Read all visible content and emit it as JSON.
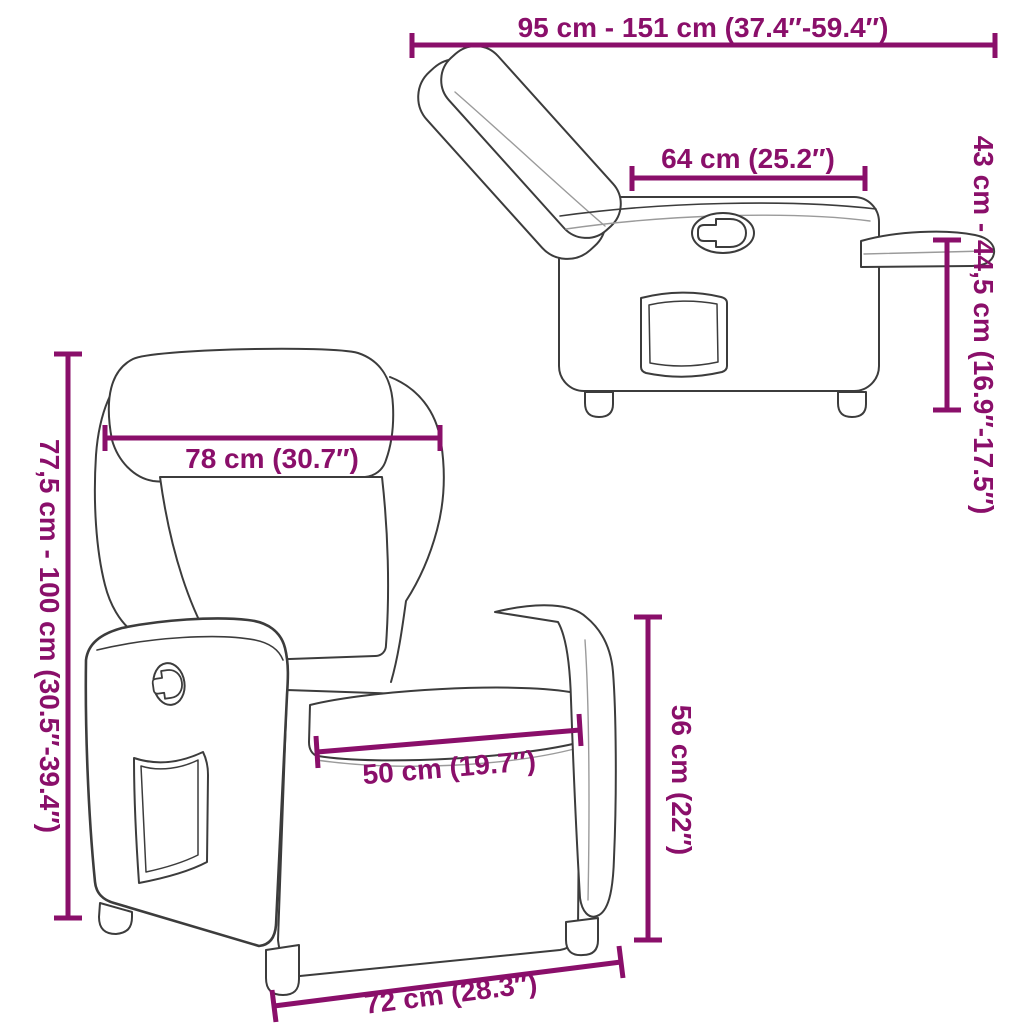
{
  "diagram_type": "furniture-dimension-diagram",
  "colors": {
    "dimension": "#8A0F6A",
    "outline": "#3C3C3C",
    "seam": "#9B9B9B",
    "background": "#FFFFFF"
  },
  "side_view": {
    "dims": {
      "total_length": "95 cm - 151 cm (37.4″-59.4″)",
      "top_depth": "64 cm (25.2″)",
      "footrest_height": "43 cm - 44,5 cm (16.9″-17.5″)"
    }
  },
  "front_view": {
    "dims": {
      "backrest_width": "78 cm (30.7″)",
      "total_height": "77,5 cm - 100 cm (30.5″-39.4″)",
      "seat_width": "50 cm (19.7″)",
      "seat_height": "56 cm (22″)",
      "base_width": "72 cm (28.3″)"
    }
  }
}
